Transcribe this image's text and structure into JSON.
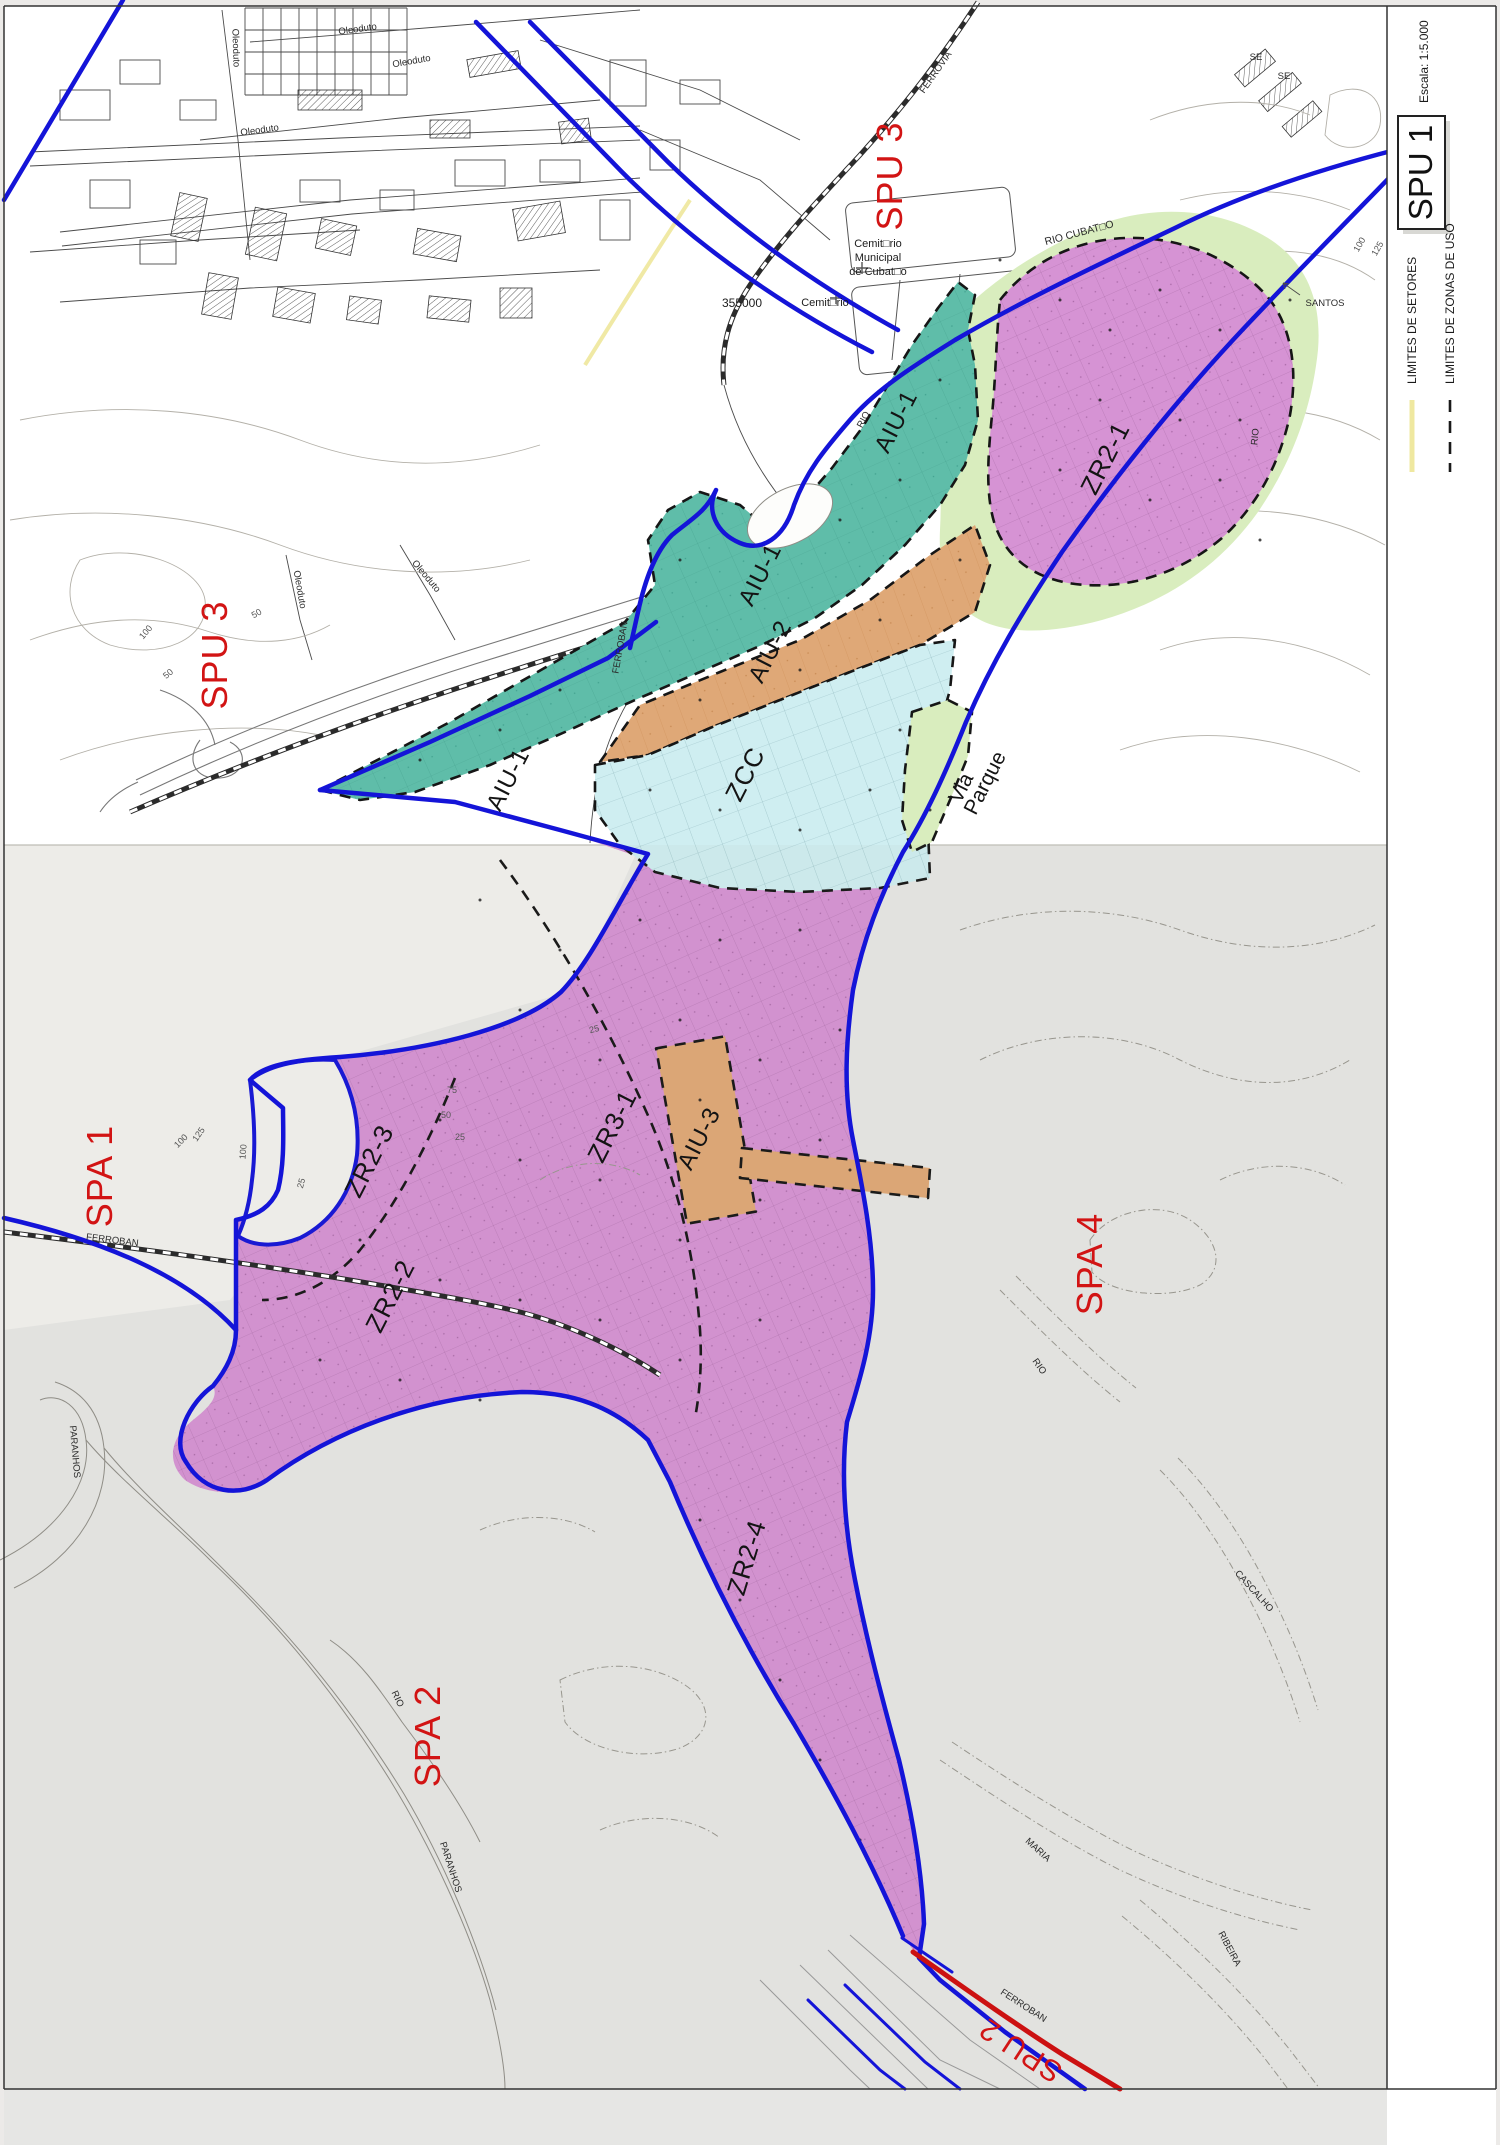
{
  "sheet": {
    "code": "SPU 1",
    "scale_label": "Escala: 1:5.000"
  },
  "legend": {
    "items": [
      {
        "label": "LIMITES DE SETORES",
        "symbol": "solid-yellow-line",
        "color": "#efe8a0"
      },
      {
        "label": "LIMITES DE ZONAS DE USO",
        "symbol": "dashed-black-line",
        "color": "#1a1a1a"
      }
    ]
  },
  "sectors": {
    "spu3_top": "SPU 3",
    "spu3_left": "SPU 3",
    "spa1": "SPA 1",
    "spa2": "SPA 2",
    "spa4": "SPA 4",
    "spu2": "SPU 2"
  },
  "zones": {
    "zr2_1": "ZR2-1",
    "zr2_2": "ZR2-2",
    "zr2_3": "ZR2-3",
    "zr2_4": "ZR2-4",
    "zr3_1": "ZR3-1",
    "aiu1_a": "AIU-1",
    "aiu1_b": "AIU-1",
    "aiu1_c": "AIU-1",
    "aiu2": "AIU-2",
    "aiu3": "AIU-3",
    "zcc": "ZCC",
    "via_parque_line1": "Via",
    "via_parque_line2": "Parque"
  },
  "places": {
    "cemiterio_l1": "Cemit□rio",
    "cemiterio_l2": "Municipal",
    "cemiterio_l3": "de Cubat□o",
    "cemiterio2": "Cemit□rio",
    "coord_355000": "355000",
    "santos": "SANTOS",
    "se1": "SE",
    "se2": "SE",
    "ferrovia": "FERROVIA",
    "ferroban_a": "FERROBAN",
    "ferroban_b": "FERROBAN",
    "ferroban_c": "FERROBAN",
    "rio_cubatao": "RIO CUBAT□O",
    "rio_a": "RIO",
    "rio_b": "RIO",
    "rio_c": "RIO",
    "rio_d": "RIO",
    "oleoduto_1": "Oleoduto",
    "oleoduto_2": "Oleoduto",
    "oleoduto_3": "Oleoduto",
    "oleoduto_4": "Oleoduto",
    "oleoduto_5": "Oleoduto",
    "oleoduto_6": "Oleoduto",
    "paranhos_1": "PARANHOS",
    "paranhos_2": "PARANHOS",
    "cascalho": "CASCALHO",
    "maria": "MARIA",
    "ribeira": "RIBEIRA"
  },
  "contours": {
    "c50_a": "50",
    "c100_a": "100",
    "c50_b": "50",
    "c100_b": "100",
    "c125_b": "125",
    "c100_c": "100",
    "c125_c": "125",
    "c100_d": "100",
    "c25_a": "25",
    "c25_b": "25",
    "c75_a": "75",
    "c50_c": "50",
    "c25_c": "25"
  },
  "colors": {
    "zone_magenta": "#d693d4",
    "zone_teal": "#5fbda9",
    "zone_orange": "#dfa877",
    "zone_cyan": "#cfeef1",
    "zone_green": "#d9edbe",
    "boundary_blue": "#1414d8",
    "sector_red": "#d21414",
    "spu2_red_line": "#cc1111",
    "limit_yellow": "#efe8a0",
    "upper_sheet_bg": "#ffffff",
    "lower_sheet_bg": "#e6e6e4"
  }
}
